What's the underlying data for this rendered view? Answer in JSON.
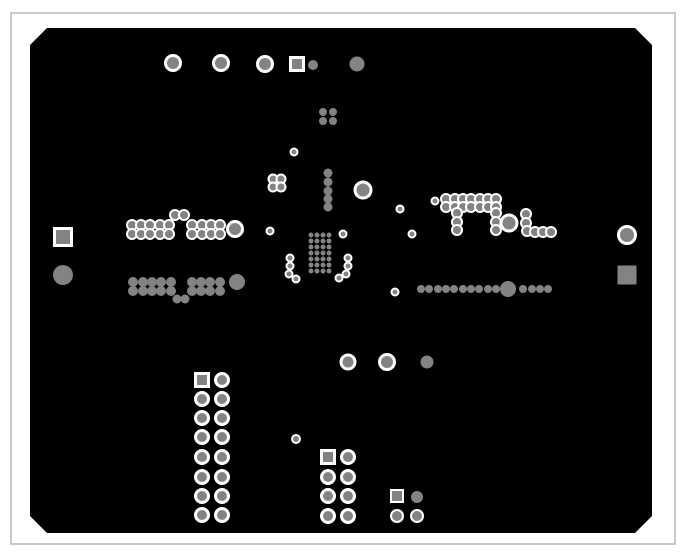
{
  "canvas": {
    "width": 685,
    "height": 558,
    "background": "#ffffff"
  },
  "frame": {
    "x": 11,
    "y": 13,
    "width": 664,
    "height": 531,
    "stroke": "#c9c9c9",
    "stroke_width": 2,
    "fill": "#ffffff"
  },
  "board": {
    "x": 30,
    "y": 28,
    "width": 622,
    "height": 505,
    "chamfer": 17,
    "fill": "#000000"
  },
  "colors": {
    "pad": "#838383",
    "ring": "#ffffff"
  },
  "pad_format": "[shape c=circle s=square, center_x, center_y, size(diameter or side), ring 1=white clearance ring 0=plain]",
  "pads": [
    [
      "c",
      173,
      63,
      15,
      1
    ],
    [
      "c",
      221,
      63,
      15,
      1
    ],
    [
      "c",
      265,
      64,
      15,
      1
    ],
    [
      "s",
      297,
      64,
      13,
      1
    ],
    [
      "c",
      313,
      65,
      10,
      0
    ],
    [
      "c",
      357,
      64,
      15,
      0
    ],
    [
      "c",
      323,
      112,
      8,
      0
    ],
    [
      "c",
      333,
      112,
      8,
      0
    ],
    [
      "c",
      323,
      121,
      8,
      0
    ],
    [
      "c",
      333,
      121,
      8,
      0
    ],
    [
      "c",
      294,
      152,
      7,
      1
    ],
    [
      "c",
      273,
      179,
      9,
      1
    ],
    [
      "c",
      281,
      179,
      9,
      1
    ],
    [
      "c",
      273,
      187,
      9,
      1
    ],
    [
      "c",
      281,
      187,
      9,
      1
    ],
    [
      "c",
      328,
      173,
      9,
      0
    ],
    [
      "c",
      328,
      182,
      9,
      0
    ],
    [
      "c",
      328,
      191,
      9,
      0
    ],
    [
      "c",
      328,
      199,
      9,
      0
    ],
    [
      "c",
      328,
      207,
      9,
      0
    ],
    [
      "c",
      363,
      190,
      16,
      1
    ],
    [
      "c",
      400,
      209,
      7,
      1
    ],
    [
      "c",
      435,
      201,
      7,
      1
    ],
    [
      "c",
      412,
      234,
      7,
      1
    ],
    [
      "c",
      343,
      234,
      7,
      1
    ],
    [
      "c",
      270,
      231,
      7,
      1
    ],
    [
      "c",
      175,
      215,
      10,
      1
    ],
    [
      "c",
      184,
      215,
      10,
      1
    ],
    [
      "c",
      132,
      225,
      10,
      1
    ],
    [
      "c",
      141,
      225,
      10,
      1
    ],
    [
      "c",
      150,
      225,
      10,
      1
    ],
    [
      "c",
      160,
      225,
      10,
      1
    ],
    [
      "c",
      169,
      225,
      10,
      1
    ],
    [
      "c",
      192,
      225,
      10,
      1
    ],
    [
      "c",
      202,
      225,
      10,
      1
    ],
    [
      "c",
      211,
      225,
      10,
      1
    ],
    [
      "c",
      220,
      225,
      10,
      1
    ],
    [
      "c",
      132,
      234,
      10,
      1
    ],
    [
      "c",
      141,
      234,
      10,
      1
    ],
    [
      "c",
      150,
      234,
      10,
      1
    ],
    [
      "c",
      160,
      234,
      10,
      1
    ],
    [
      "c",
      169,
      234,
      10,
      1
    ],
    [
      "c",
      192,
      234,
      10,
      1
    ],
    [
      "c",
      202,
      234,
      10,
      1
    ],
    [
      "c",
      211,
      234,
      10,
      1
    ],
    [
      "c",
      220,
      234,
      10,
      1
    ],
    [
      "c",
      235,
      229,
      15,
      1
    ],
    [
      "c",
      133,
      282,
      10,
      0
    ],
    [
      "c",
      143,
      282,
      10,
      0
    ],
    [
      "c",
      152,
      282,
      10,
      0
    ],
    [
      "c",
      161,
      282,
      10,
      0
    ],
    [
      "c",
      171,
      282,
      10,
      0
    ],
    [
      "c",
      192,
      282,
      10,
      0
    ],
    [
      "c",
      201,
      282,
      10,
      0
    ],
    [
      "c",
      210,
      282,
      10,
      0
    ],
    [
      "c",
      220,
      282,
      10,
      0
    ],
    [
      "c",
      133,
      291,
      10,
      0
    ],
    [
      "c",
      143,
      291,
      10,
      0
    ],
    [
      "c",
      152,
      291,
      10,
      0
    ],
    [
      "c",
      161,
      291,
      10,
      0
    ],
    [
      "c",
      171,
      291,
      10,
      0
    ],
    [
      "c",
      192,
      291,
      10,
      0
    ],
    [
      "c",
      201,
      291,
      10,
      0
    ],
    [
      "c",
      210,
      291,
      10,
      0
    ],
    [
      "c",
      220,
      291,
      10,
      0
    ],
    [
      "c",
      177,
      299,
      9,
      0
    ],
    [
      "c",
      185,
      299,
      9,
      0
    ],
    [
      "c",
      237,
      282,
      16,
      0
    ],
    [
      "c",
      290,
      258,
      7,
      1
    ],
    [
      "c",
      290,
      266,
      7,
      1
    ],
    [
      "c",
      289,
      274,
      7,
      1
    ],
    [
      "c",
      296,
      279,
      7,
      1
    ],
    [
      "c",
      311,
      235,
      5,
      0
    ],
    [
      "c",
      317,
      235,
      5,
      0
    ],
    [
      "c",
      323,
      235,
      5,
      0
    ],
    [
      "c",
      329,
      235,
      5,
      0
    ],
    [
      "c",
      311,
      241,
      5,
      0
    ],
    [
      "c",
      317,
      241,
      5,
      0
    ],
    [
      "c",
      323,
      241,
      5,
      0
    ],
    [
      "c",
      329,
      241,
      5,
      0
    ],
    [
      "c",
      311,
      247,
      5,
      0
    ],
    [
      "c",
      317,
      247,
      5,
      0
    ],
    [
      "c",
      323,
      247,
      5,
      0
    ],
    [
      "c",
      329,
      247,
      5,
      0
    ],
    [
      "c",
      311,
      253,
      5,
      0
    ],
    [
      "c",
      317,
      253,
      5,
      0
    ],
    [
      "c",
      323,
      253,
      5,
      0
    ],
    [
      "c",
      329,
      253,
      5,
      0
    ],
    [
      "c",
      311,
      259,
      5,
      0
    ],
    [
      "c",
      317,
      259,
      5,
      0
    ],
    [
      "c",
      323,
      259,
      5,
      0
    ],
    [
      "c",
      329,
      259,
      5,
      0
    ],
    [
      "c",
      311,
      265,
      5,
      0
    ],
    [
      "c",
      317,
      265,
      5,
      0
    ],
    [
      "c",
      323,
      265,
      5,
      0
    ],
    [
      "c",
      329,
      265,
      5,
      0
    ],
    [
      "c",
      311,
      271,
      5,
      0
    ],
    [
      "c",
      317,
      271,
      5,
      0
    ],
    [
      "c",
      323,
      271,
      5,
      0
    ],
    [
      "c",
      329,
      271,
      5,
      0
    ],
    [
      "c",
      348,
      258,
      7,
      1
    ],
    [
      "c",
      348,
      266,
      7,
      1
    ],
    [
      "c",
      346,
      274,
      7,
      1
    ],
    [
      "c",
      339,
      278,
      7,
      1
    ],
    [
      "c",
      446,
      199,
      10,
      1
    ],
    [
      "c",
      455,
      199,
      10,
      1
    ],
    [
      "c",
      463,
      199,
      10,
      1
    ],
    [
      "c",
      471,
      199,
      10,
      1
    ],
    [
      "c",
      480,
      199,
      10,
      1
    ],
    [
      "c",
      488,
      199,
      10,
      1
    ],
    [
      "c",
      496,
      199,
      10,
      1
    ],
    [
      "c",
      446,
      207,
      10,
      1
    ],
    [
      "c",
      455,
      207,
      10,
      1
    ],
    [
      "c",
      463,
      207,
      10,
      1
    ],
    [
      "c",
      471,
      207,
      10,
      1
    ],
    [
      "c",
      480,
      207,
      10,
      1
    ],
    [
      "c",
      488,
      207,
      10,
      1
    ],
    [
      "c",
      496,
      207,
      10,
      1
    ],
    [
      "c",
      457,
      213,
      10,
      1
    ],
    [
      "c",
      457,
      222,
      10,
      1
    ],
    [
      "c",
      457,
      230,
      10,
      1
    ],
    [
      "c",
      496,
      213,
      10,
      1
    ],
    [
      "c",
      496,
      222,
      10,
      1
    ],
    [
      "c",
      496,
      230,
      10,
      1
    ],
    [
      "c",
      509,
      223,
      16,
      1
    ],
    [
      "c",
      526,
      214,
      10,
      1
    ],
    [
      "c",
      526,
      223,
      10,
      1
    ],
    [
      "c",
      527,
      231,
      10,
      1
    ],
    [
      "c",
      535,
      232,
      10,
      1
    ],
    [
      "c",
      543,
      232,
      10,
      1
    ],
    [
      "c",
      551,
      232,
      10,
      1
    ],
    [
      "c",
      421,
      289,
      8,
      0
    ],
    [
      "c",
      429,
      289,
      8,
      0
    ],
    [
      "c",
      438,
      289,
      8,
      0
    ],
    [
      "c",
      446,
      289,
      8,
      0
    ],
    [
      "c",
      454,
      289,
      8,
      0
    ],
    [
      "c",
      463,
      289,
      8,
      0
    ],
    [
      "c",
      471,
      289,
      8,
      0
    ],
    [
      "c",
      479,
      289,
      8,
      0
    ],
    [
      "c",
      488,
      289,
      8,
      0
    ],
    [
      "c",
      496,
      289,
      8,
      0
    ],
    [
      "c",
      508,
      289,
      16,
      0
    ],
    [
      "c",
      523,
      289,
      8,
      0
    ],
    [
      "c",
      532,
      289,
      8,
      0
    ],
    [
      "c",
      540,
      289,
      8,
      0
    ],
    [
      "c",
      548,
      289,
      8,
      0
    ],
    [
      "c",
      395,
      292,
      7,
      1
    ],
    [
      "c",
      348,
      362,
      14,
      1
    ],
    [
      "c",
      387,
      362,
      15,
      1
    ],
    [
      "c",
      427,
      362,
      13,
      0
    ],
    [
      "c",
      296,
      439,
      8,
      1
    ],
    [
      "s",
      202,
      380,
      13,
      1
    ],
    [
      "c",
      222,
      380,
      13,
      1
    ],
    [
      "c",
      202,
      399,
      13,
      1
    ],
    [
      "c",
      222,
      399,
      13,
      1
    ],
    [
      "c",
      202,
      418,
      13,
      1
    ],
    [
      "c",
      222,
      418,
      13,
      1
    ],
    [
      "c",
      202,
      437,
      13,
      1
    ],
    [
      "c",
      222,
      437,
      13,
      1
    ],
    [
      "c",
      202,
      457,
      13,
      1
    ],
    [
      "c",
      222,
      457,
      13,
      1
    ],
    [
      "c",
      202,
      477,
      13,
      1
    ],
    [
      "c",
      222,
      477,
      13,
      1
    ],
    [
      "c",
      202,
      496,
      13,
      1
    ],
    [
      "c",
      222,
      496,
      13,
      1
    ],
    [
      "c",
      202,
      515,
      13,
      1
    ],
    [
      "c",
      222,
      515,
      13,
      1
    ],
    [
      "s",
      328,
      457,
      13,
      1
    ],
    [
      "c",
      348,
      457,
      13,
      1
    ],
    [
      "c",
      328,
      477,
      13,
      1
    ],
    [
      "c",
      348,
      477,
      13,
      1
    ],
    [
      "c",
      328,
      496,
      13,
      1
    ],
    [
      "c",
      348,
      496,
      13,
      1
    ],
    [
      "c",
      328,
      516,
      13,
      1
    ],
    [
      "c",
      348,
      516,
      13,
      1
    ],
    [
      "s",
      397,
      496,
      12,
      1
    ],
    [
      "c",
      417,
      497,
      12,
      0
    ],
    [
      "c",
      397,
      516,
      12,
      1
    ],
    [
      "c",
      417,
      516,
      12,
      1
    ],
    [
      "s",
      63,
      237,
      17,
      1
    ],
    [
      "c",
      63,
      275,
      20,
      0
    ],
    [
      "c",
      627,
      235,
      17,
      1
    ],
    [
      "s",
      627,
      275,
      19,
      0
    ]
  ]
}
